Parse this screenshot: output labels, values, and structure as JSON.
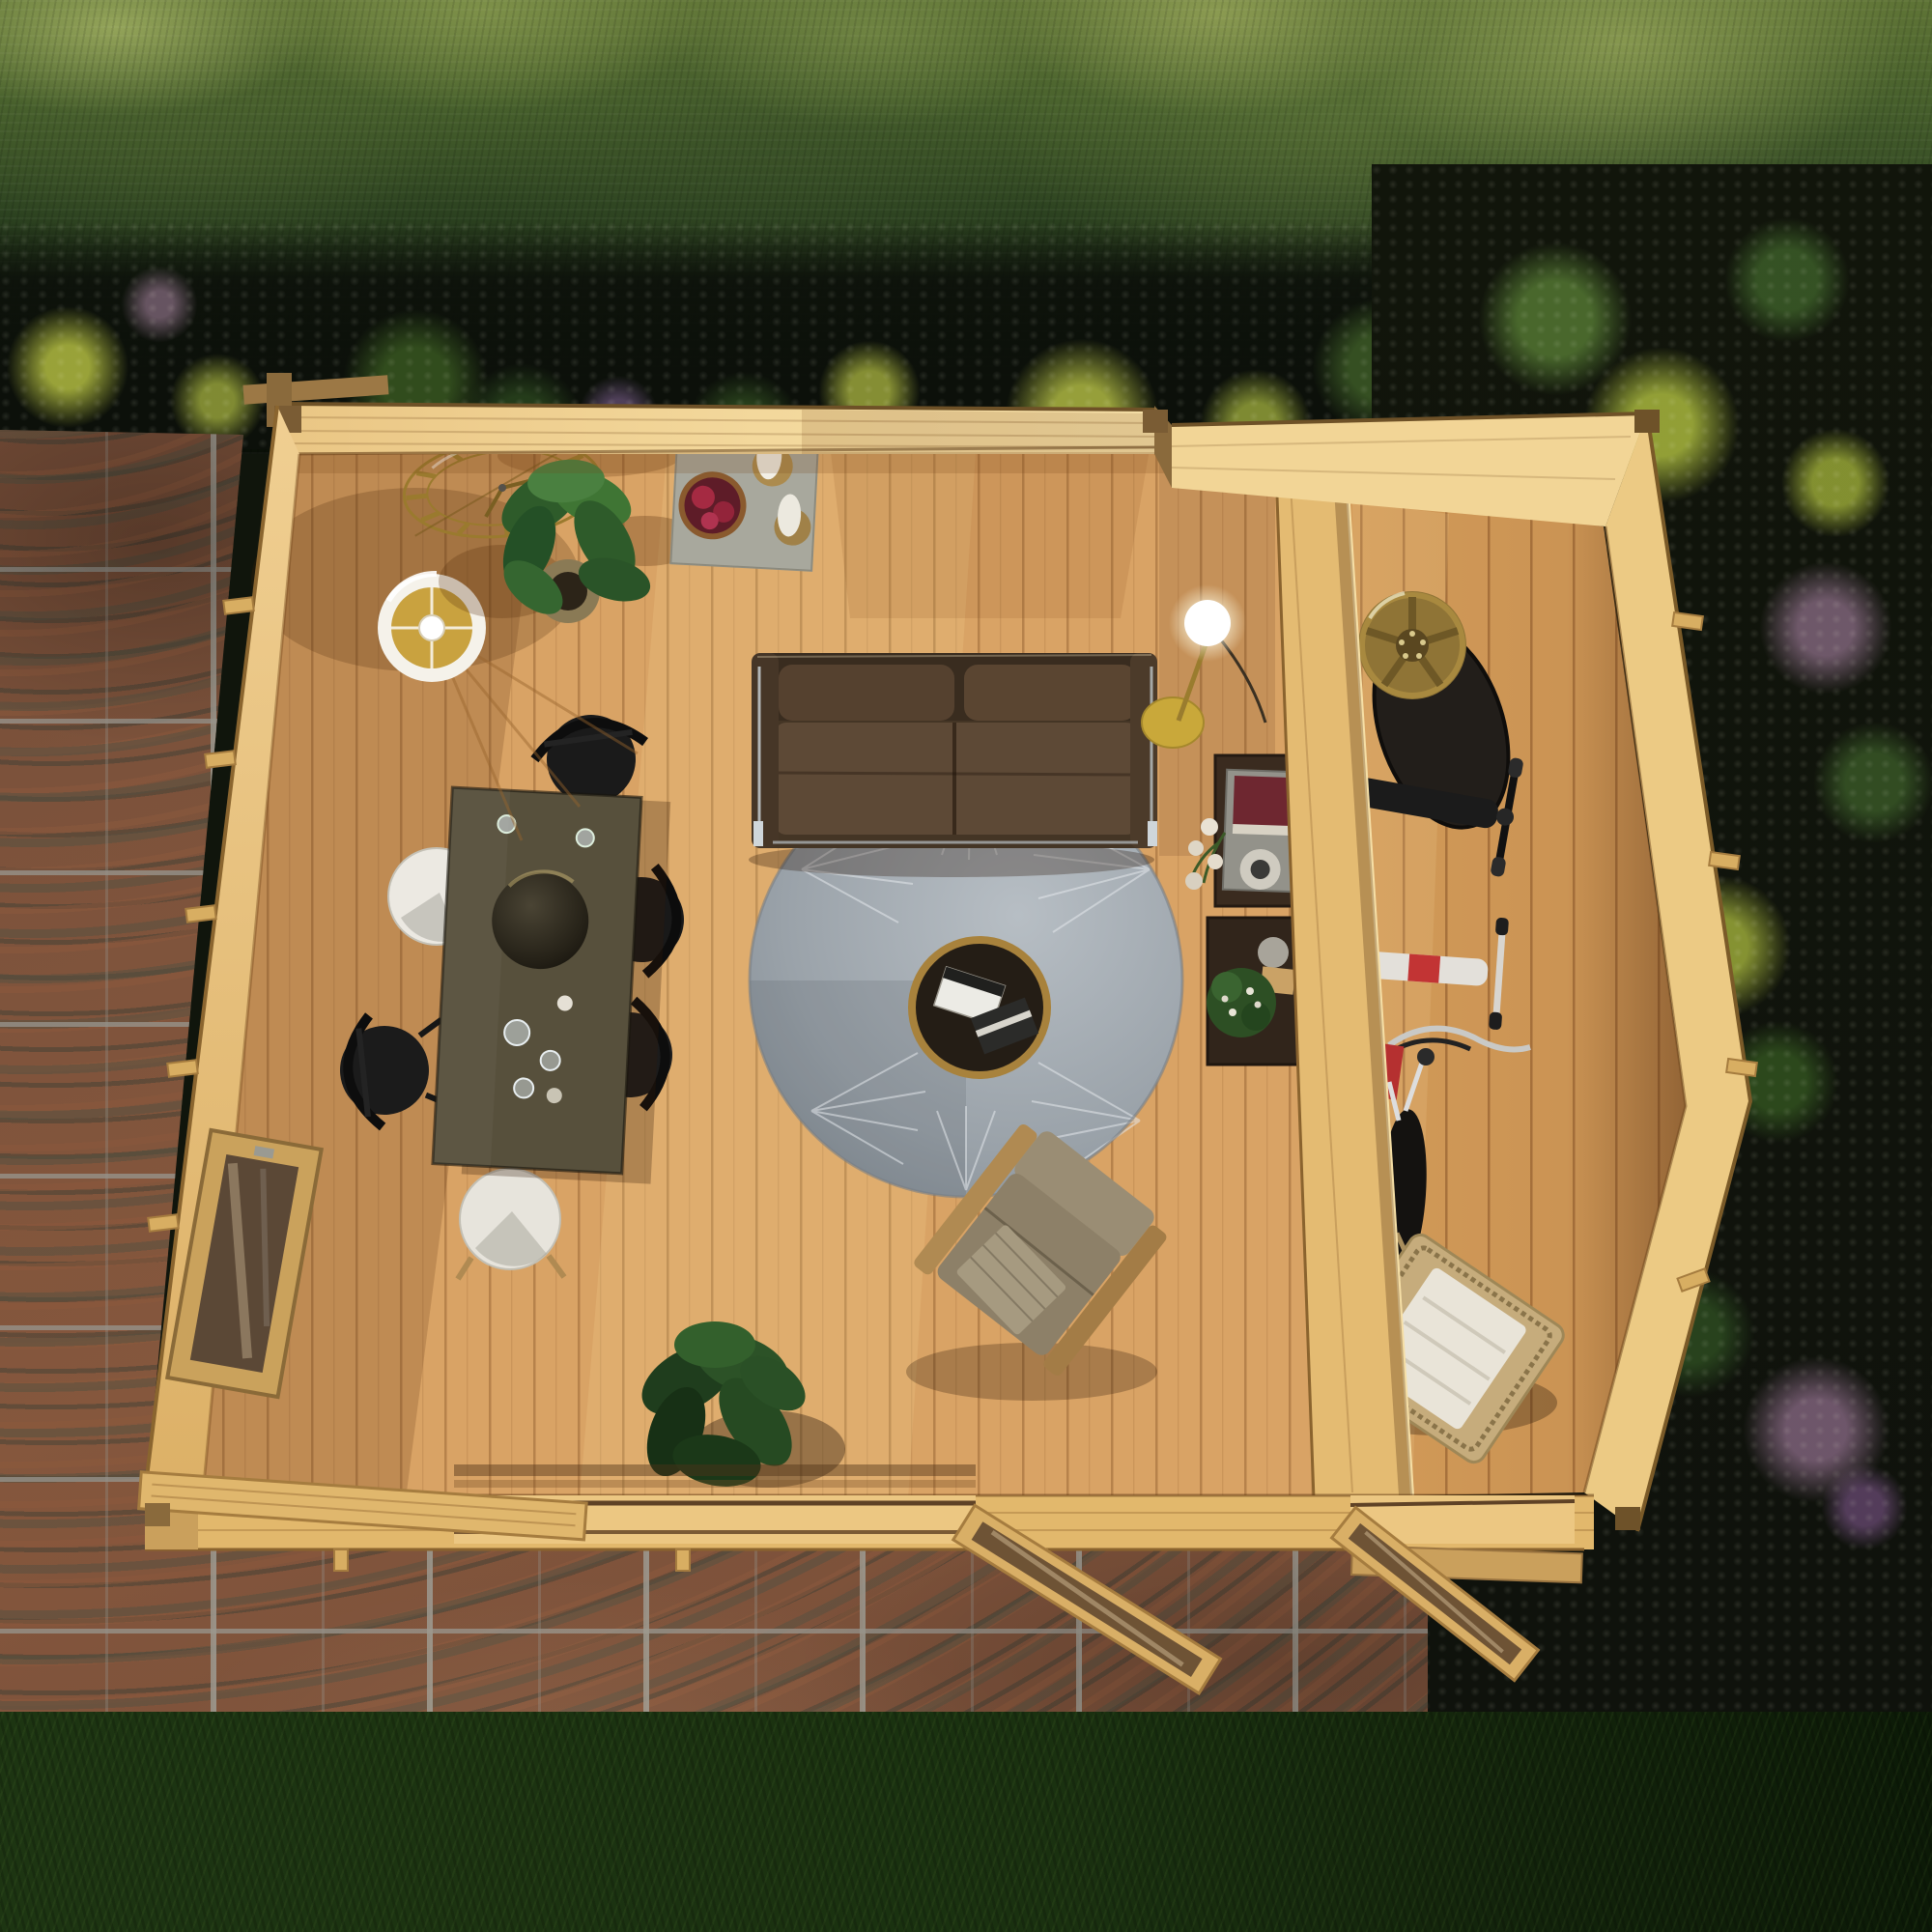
{
  "scene": {
    "title": "Aerial top-down 3D render of a two-room timber garden cabin with open doors",
    "setting": {
      "hedge": "Dense green hedge along the top edge",
      "flower_bed_top": "Shaded border bed with yellow and purple blooms behind the cabin",
      "flower_bed_right": "Border bed with yellow, pink and purple blooms beside the cabin",
      "patio": "Terracotta stone paving wrapping the left and front of the cabin",
      "lawn": "Dark green lawn strip across the bottom"
    },
    "building": {
      "type": "Light pine log cabin viewed from directly above with roof removed",
      "main_room_door": "Wide double door opening onto the patio, leaves swung open",
      "annex_door": "Single glazed door of the side store room swung open",
      "window": "Glazed window in the left wall",
      "partition": "Full-height timber partition between lounge and store room"
    },
    "main_room": {
      "labels": {
        "clock": "Brass roman-numeral wall clock",
        "candle_tray": "Stone tray with two candles and a bowl of fruit",
        "plant_top": "Potted green plant by the back wall",
        "tripod_lamp": "Tripod floor lamp with white drum shade",
        "sofa": "Two-seat dark leather sofa with chrome frame",
        "rug": "Round grey rug with leaf pattern",
        "coffee_table": "Round brass-rim coffee table holding magazines",
        "armchair": "Taupe lounge armchair with throw blanket",
        "dining_table": "Rectangular stone-top dining table with centrepiece bowl and glasses",
        "black_chairs": "Four black wishbone dining chairs",
        "white_chairs": "Two white shell dining chairs",
        "globe_lamp": "Glowing globe floor lamp beside the partition",
        "side_tables": "Dark side tables with book, vase, flowers and plant",
        "plant_door": "Leafy green plant beside the doorway"
      }
    },
    "annex": {
      "labels": {
        "wheel": "Alloy car wheel with tyre leaning on the partition",
        "scooters": "Two kick scooters parked against the partition",
        "bicycle": "Bicycle with red pannier",
        "lounger": "Rattan lounger with white cushion"
      }
    },
    "palette": {
      "pine_wall": "#e8c07a",
      "floor": "#d9a365",
      "sofa_leather": "#52402f",
      "rug_grey": "#9aa2a9",
      "patio_stone": "#7c523b",
      "hedge_green": "#47602c",
      "lawn_green": "#1a3110",
      "brass_accent": "#b08c3a",
      "flower_yellow": "#a8b73e",
      "flower_pink": "#b18bac"
    }
  }
}
